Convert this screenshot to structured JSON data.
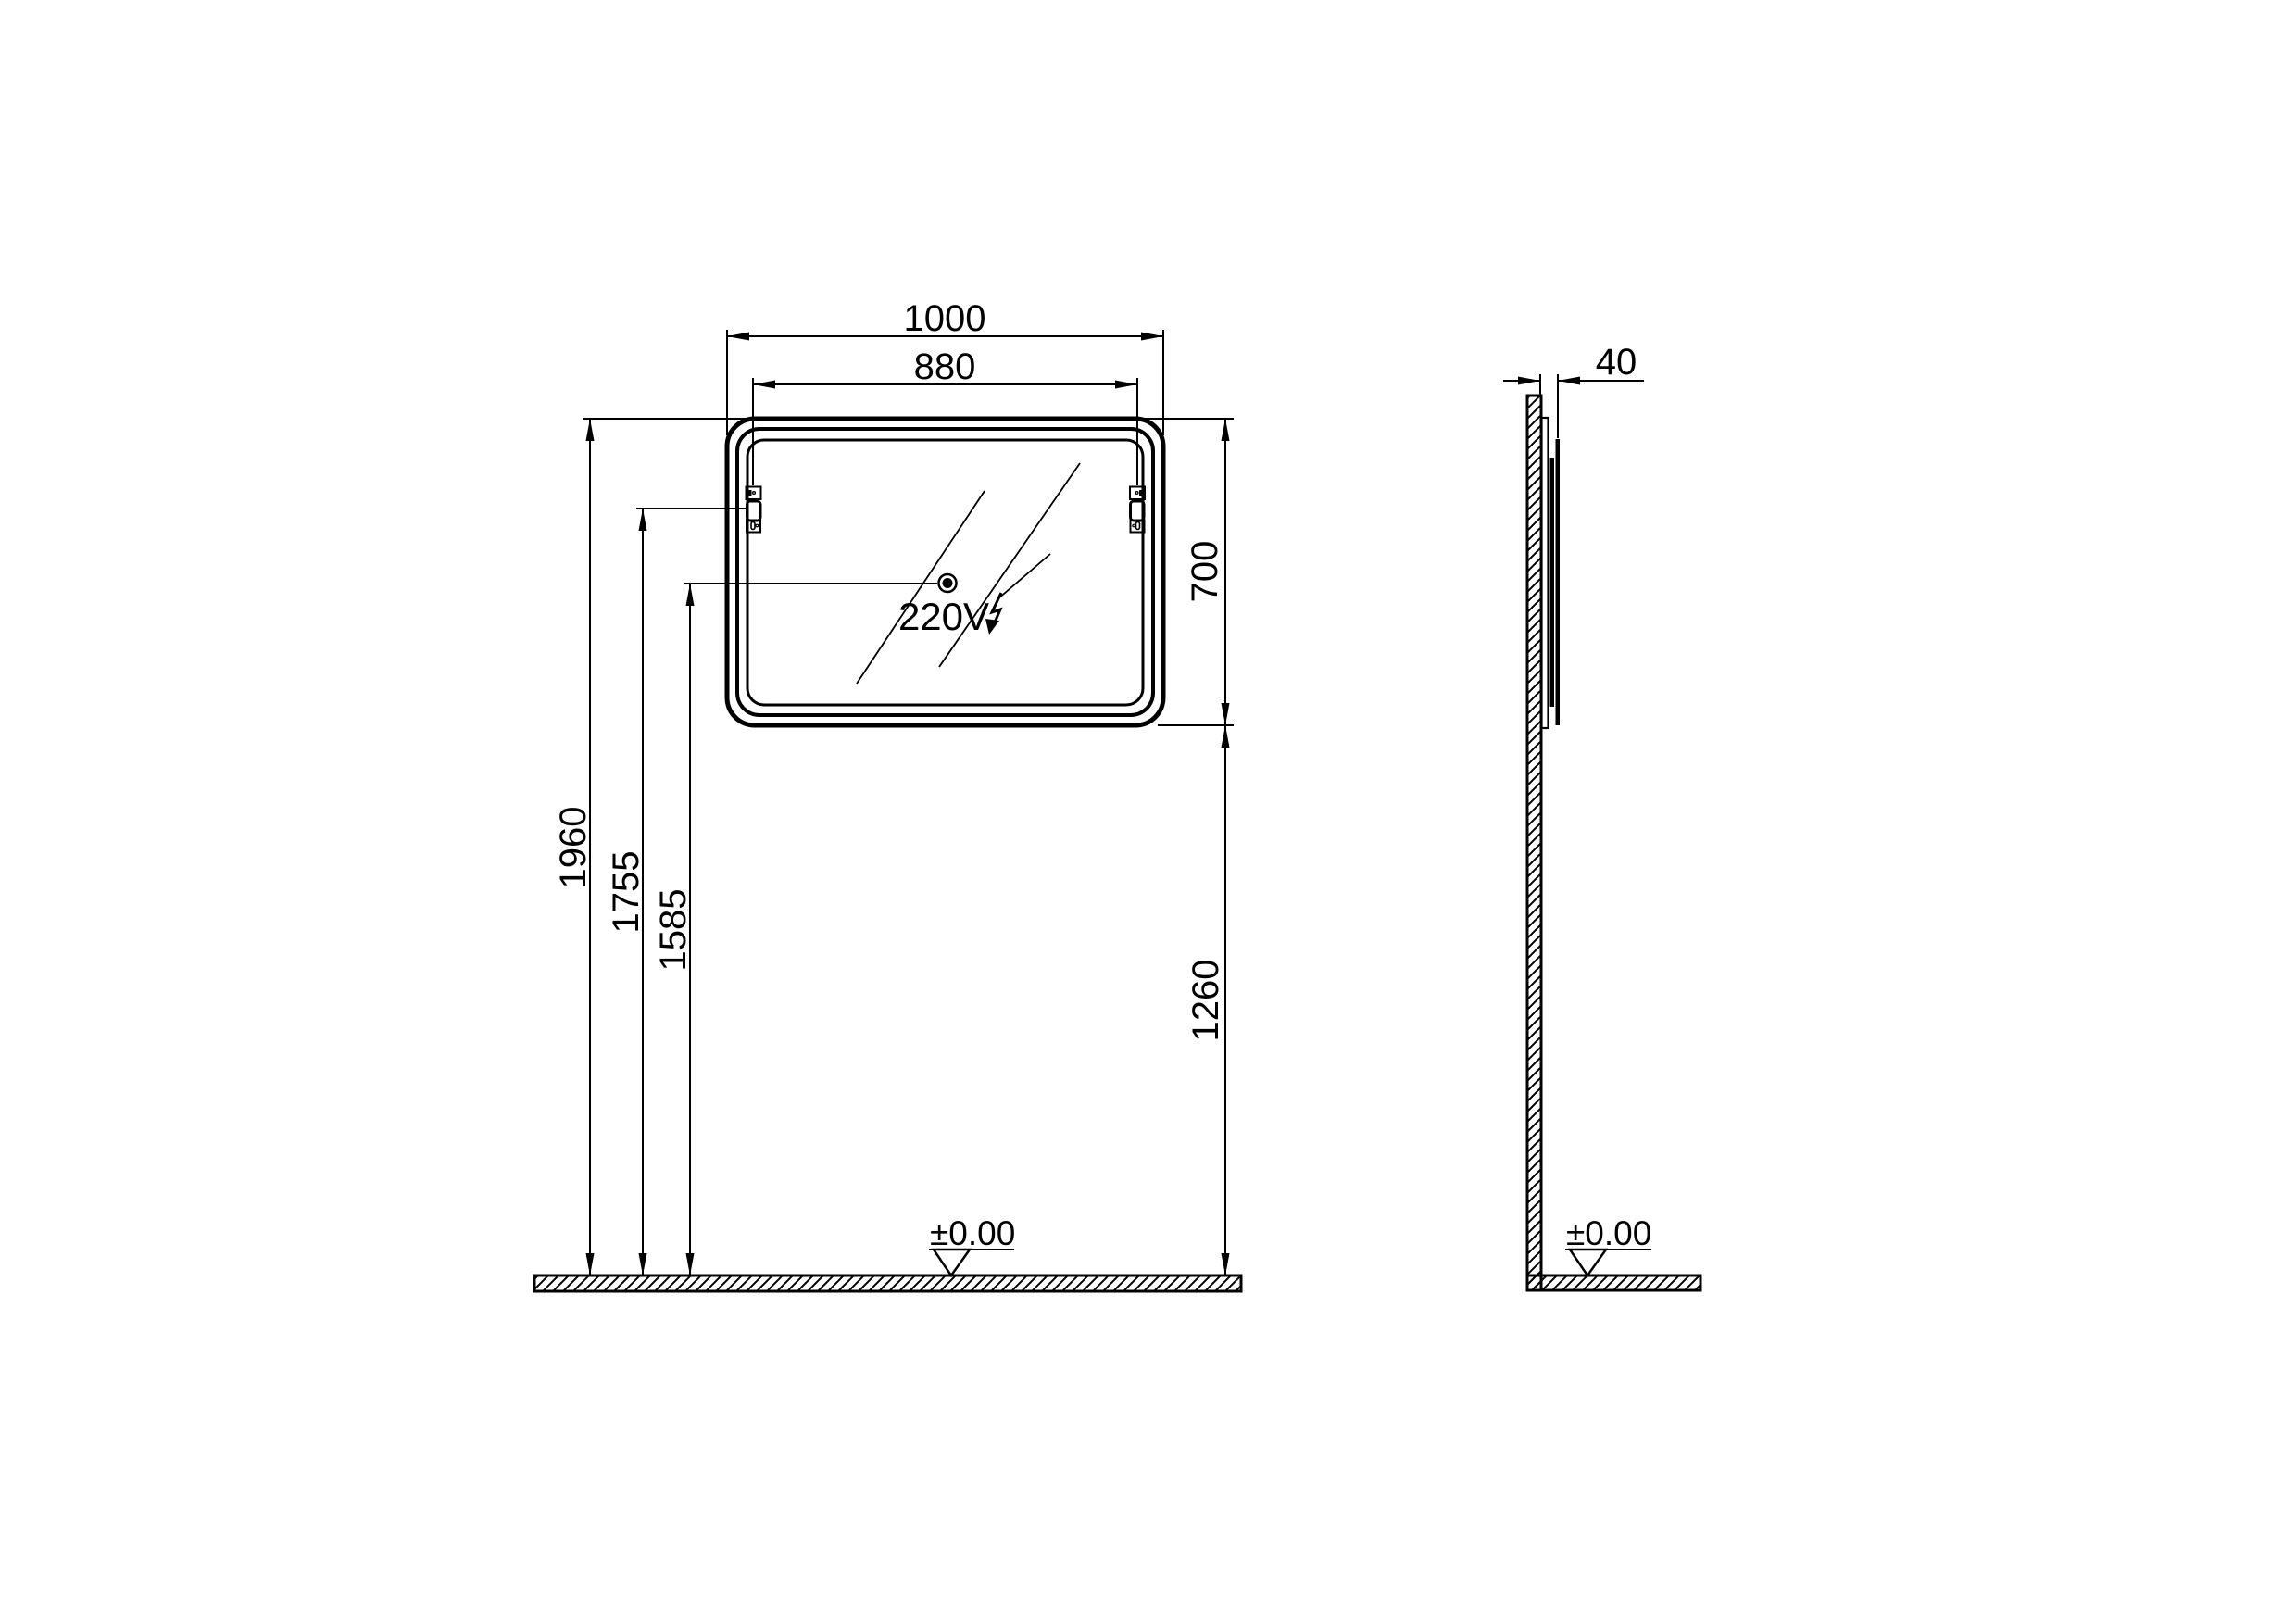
{
  "drawing": {
    "type": "technical-installation-drawing",
    "subject": "wall-mounted LED mirror, front and side elevation",
    "colors": {
      "line": "#000000",
      "background": "#ffffff"
    },
    "front_view": {
      "dims": {
        "total_width": "1000",
        "bracket_width": "880",
        "mirror_height": "700",
        "top_height": "1960",
        "bracket_height": "1755",
        "outlet_height": "1585",
        "below_height": "1260"
      },
      "power_label": "220V",
      "level_label": "±0.00"
    },
    "side_view": {
      "dims": {
        "depth": "40"
      },
      "level_label": "±0.00"
    }
  }
}
